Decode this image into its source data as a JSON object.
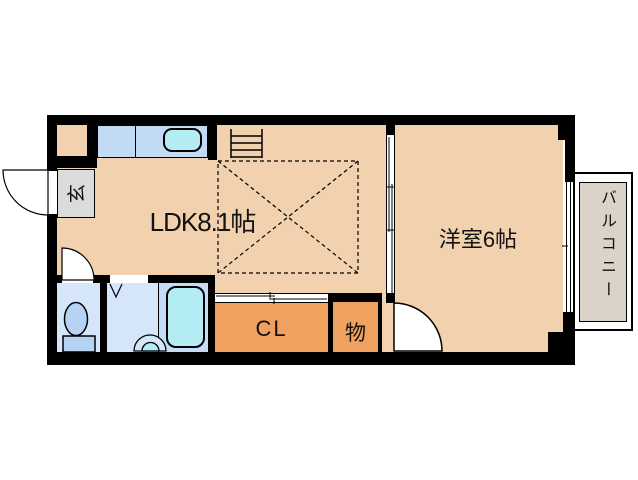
{
  "floorplan": {
    "rooms": {
      "ldk": {
        "label": "LDK8.1帖",
        "size_tatami": "8.1"
      },
      "western_room": {
        "label": "洋室6帖",
        "size_tatami": "6"
      },
      "closet": {
        "label": "CL"
      },
      "storage": {
        "label": "物"
      },
      "entrance": {
        "label": "玄"
      },
      "balcony": {
        "label": "バルコニー"
      }
    },
    "fixtures": {
      "kitchen_sink": "sink-icon",
      "bathtub": "bathtub-icon",
      "toilet": "toilet-icon",
      "washbasin": "washbasin-icon",
      "range": "ladder-icon"
    },
    "colors": {
      "wall": "#000000",
      "floor_peach": "#F2D2AE",
      "closet_orange": "#F0A15F",
      "counter_blue": "#C3DAF5",
      "fixture_cyan": "#B3EDF3",
      "wetroom_blue": "#D5E6FA",
      "fixture_blue": "#B7D3F3",
      "tubzone_blue": "#C5DCF6",
      "genkan_gray": "#DBDBDB",
      "balcony_gray": "#DBD2C8"
    }
  }
}
